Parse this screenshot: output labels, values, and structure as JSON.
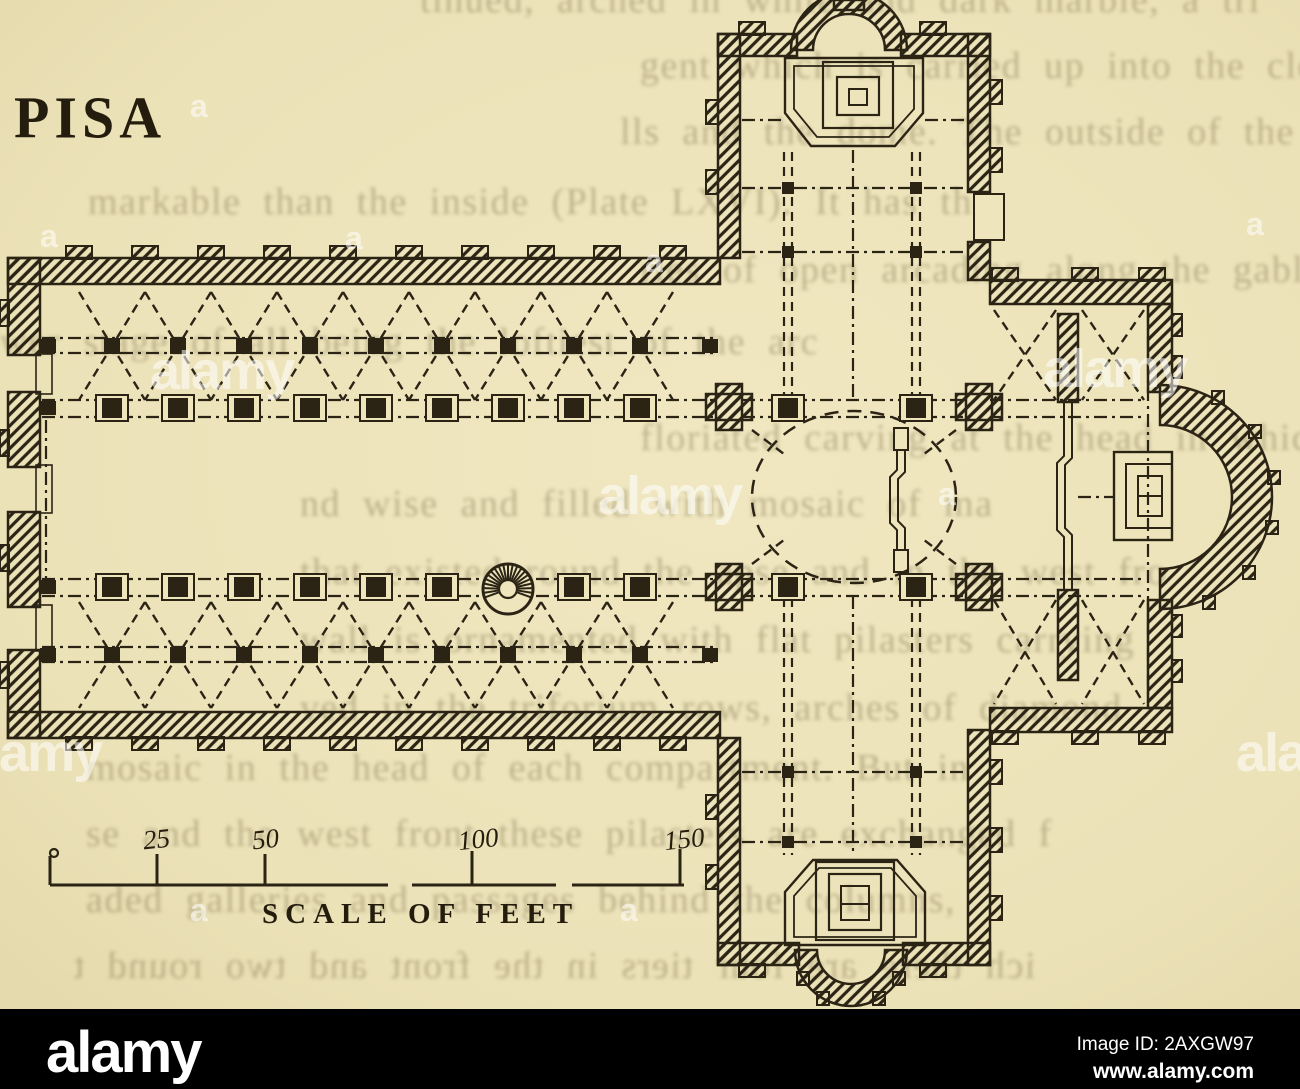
{
  "plan": {
    "title": "PISA",
    "scale_bar": {
      "ticks": [
        "25",
        "50",
        "100",
        "150"
      ],
      "label": "SCALE OF FEET"
    }
  },
  "page_showthrough": {
    "lines": [
      "tinued, arched in white and dark marble, a tri",
      "gent which is carried up into the clerestory, the c",
      "lls and the dome.  The outside of the church is mo",
      "markable than the inside (Plate LXVI).  It has the",
      "ries of open arcading along the gables of",
      "wer stage of all being the loftiest of the arc",
      "floriated carving at the head in which are squ",
      "nd wise and filled with mosaic of ma",
      "that existed round the apse and in the west fro",
      "wall is ornamented with flat pilasters carrying",
      "ved in the triforium rows, arches of diamond",
      "mosaic in the head of each compartment.  But in",
      "se and the west front these pilasters are exchanged f",
      "aded galleries and passages behind the columns,",
      "ich there are four tiers in the front and two round t"
    ]
  },
  "watermark": {
    "logo_text": "alamy",
    "glyph_text": "a"
  },
  "footer": {
    "logo_text": "alamy",
    "image_id": "Image ID: 2AXGW97",
    "website": "www.alamy.com"
  },
  "colors": {
    "paper": "#eee5bd",
    "ink": "#2b2415",
    "black_bar": "#000000",
    "watermark_white": "rgba(255,255,255,0.55)",
    "showthrough": "#8d815a"
  }
}
